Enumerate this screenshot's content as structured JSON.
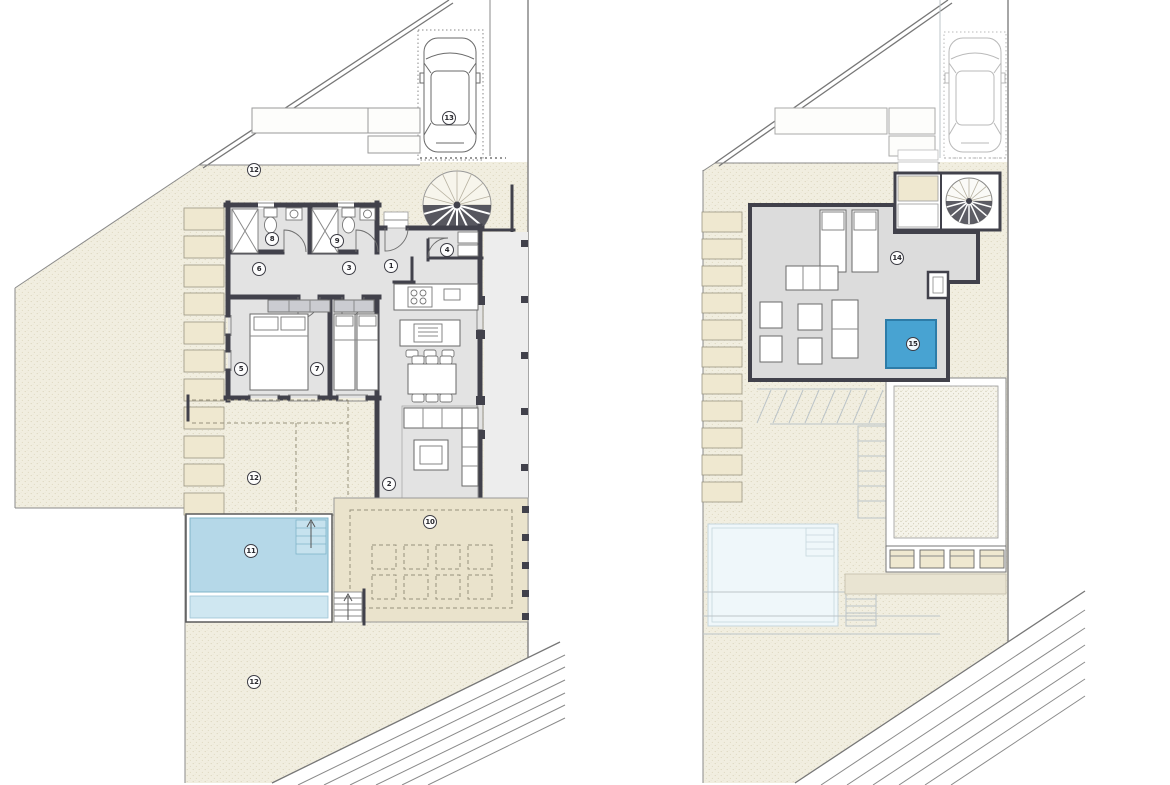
{
  "canvas": {
    "width": 1170,
    "height": 785,
    "background": "#ffffff"
  },
  "colors": {
    "terrain": "#f1eee0",
    "terrain_dot": "#d7d1b6",
    "wall": "#41414b",
    "floor": "#e3e3e3",
    "floor2": "#dcdcdc",
    "passage": "#ededed",
    "pool": "#b5d8e8",
    "pool_shallow": "#cfe7f1",
    "pool_ghost": "#eff7fa",
    "jacuzzi": "#48a3d2",
    "jacuzzi_border": "#2d7ca8",
    "terrace": "#eae3cc",
    "step": "#efe8d0",
    "stipple": "#f5f3ea",
    "stipple_dot": "#c8c2a9",
    "line": "#8a8a8a",
    "ghost": "#bcc4c8"
  },
  "labels": {
    "plan1": [
      "1",
      "2",
      "3",
      "4",
      "5",
      "6",
      "7",
      "8",
      "9",
      "10",
      "11",
      "12",
      "12",
      "12",
      "13"
    ],
    "plan2": [
      "14",
      "15"
    ]
  },
  "icons": {
    "car": "car-icon",
    "spiral_staircase": "spiral-staircase-icon",
    "north_arrow": "up-arrow-icon"
  }
}
